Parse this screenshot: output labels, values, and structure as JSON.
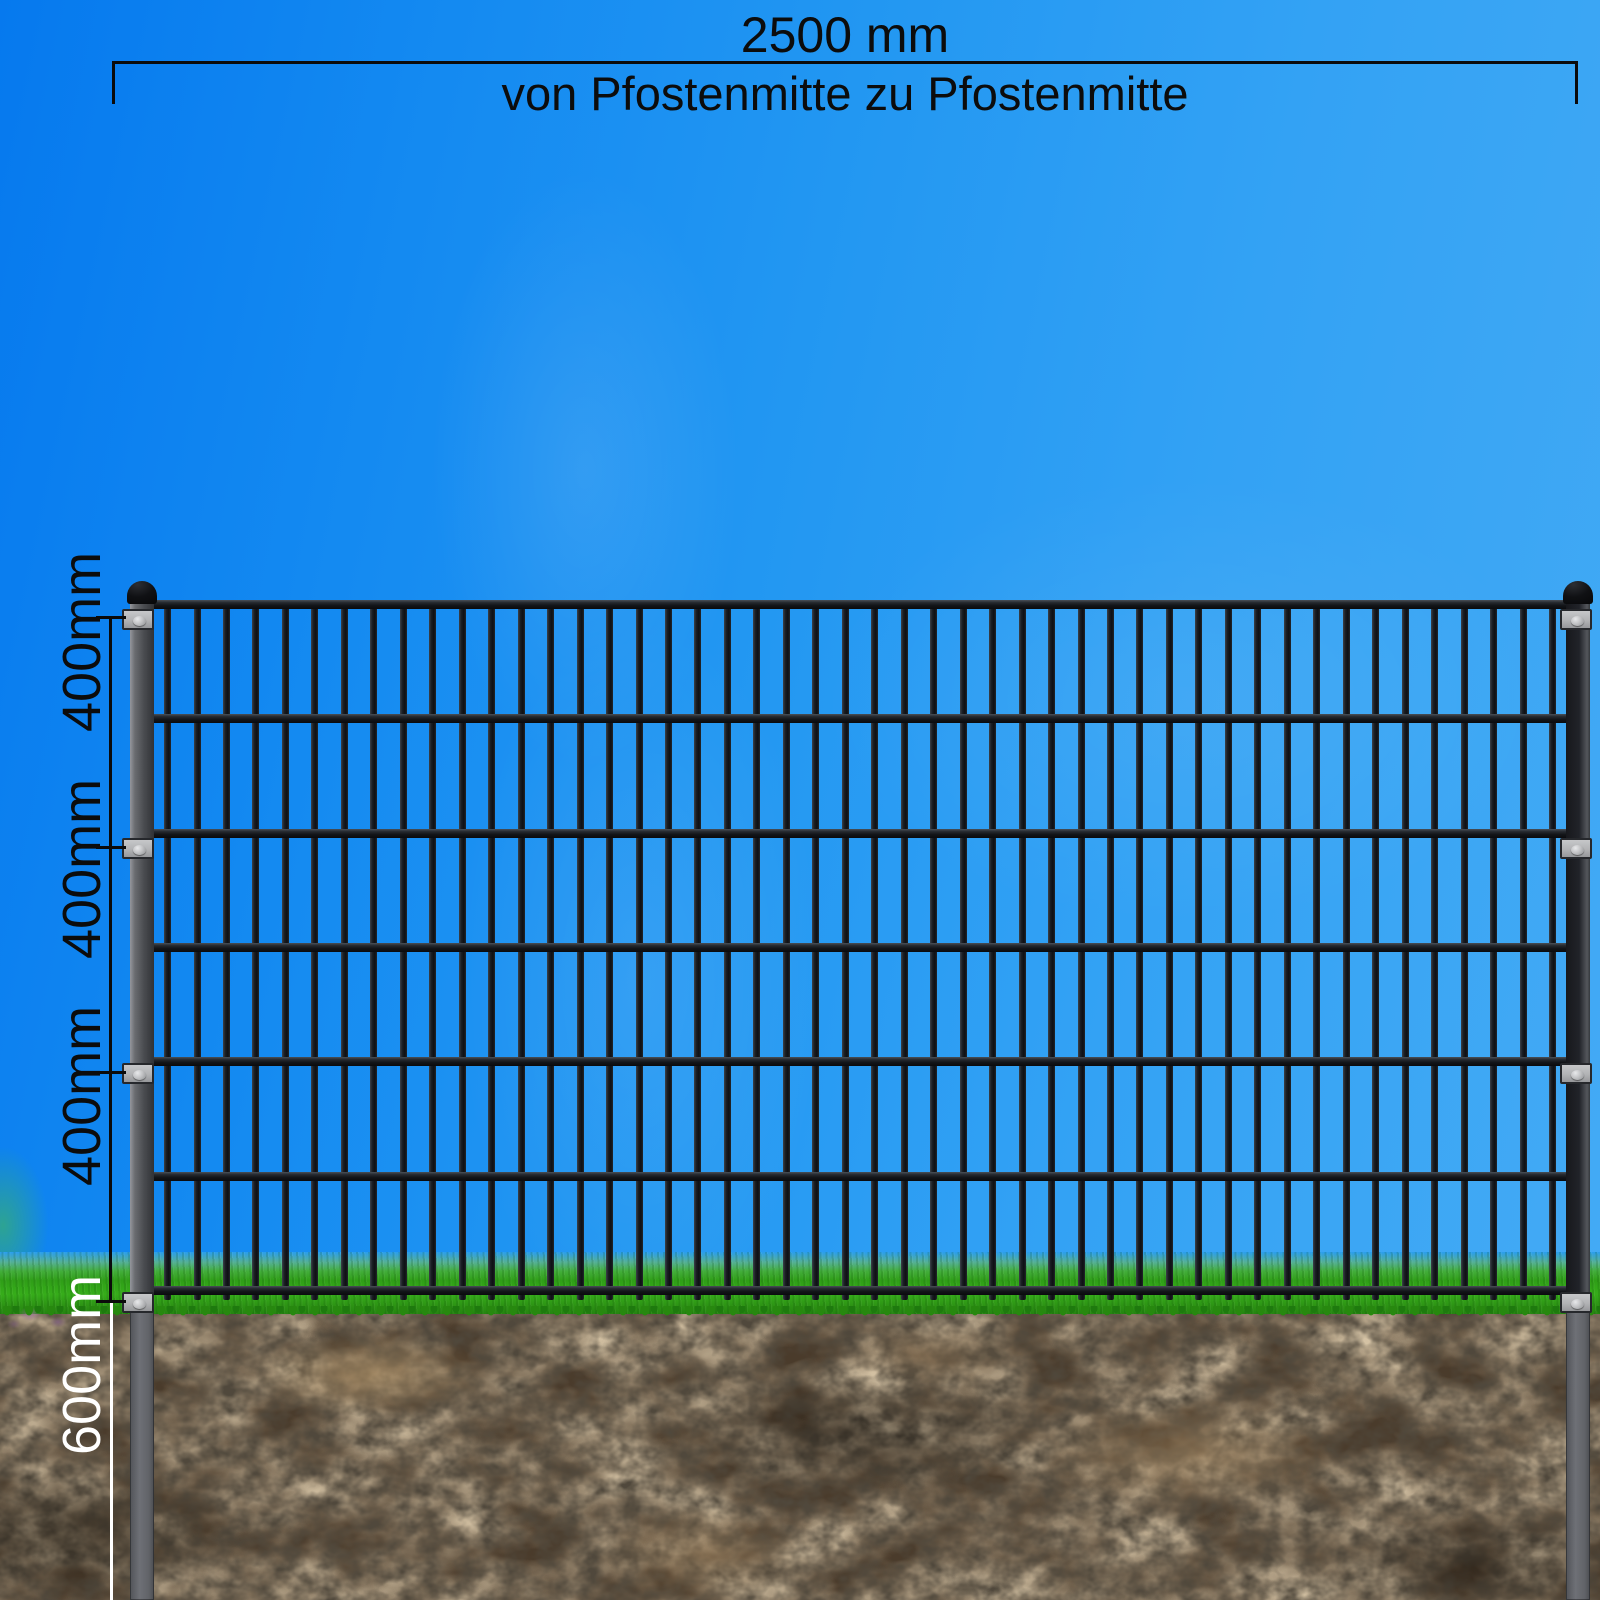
{
  "diagram": {
    "title_dimension": {
      "value": "2500 mm",
      "subtitle": "von Pfostenmitte zu Pfostenmitte"
    },
    "left_dimension": {
      "segment_labels": [
        "400mm",
        "400mm",
        "400mm"
      ]
    },
    "underground_dimension": {
      "label": "600mm"
    },
    "fence": {
      "vertical_bar_count": 48,
      "horizontal_rail_count": 7,
      "post_count": 2,
      "bracket_rows_per_post": 4
    },
    "colors": {
      "sky_top_left": "#0679ee",
      "sky_top_right": "#45abf5",
      "grass_green": "#2f9e17",
      "soil_brown": "#443829",
      "metal_dark": "#17191d",
      "post_gray": "#5a5d62",
      "bracket_gray": "#b4b5b7",
      "dimension_black": "#0b0b0b",
      "dimension_white": "#ffffff"
    }
  }
}
